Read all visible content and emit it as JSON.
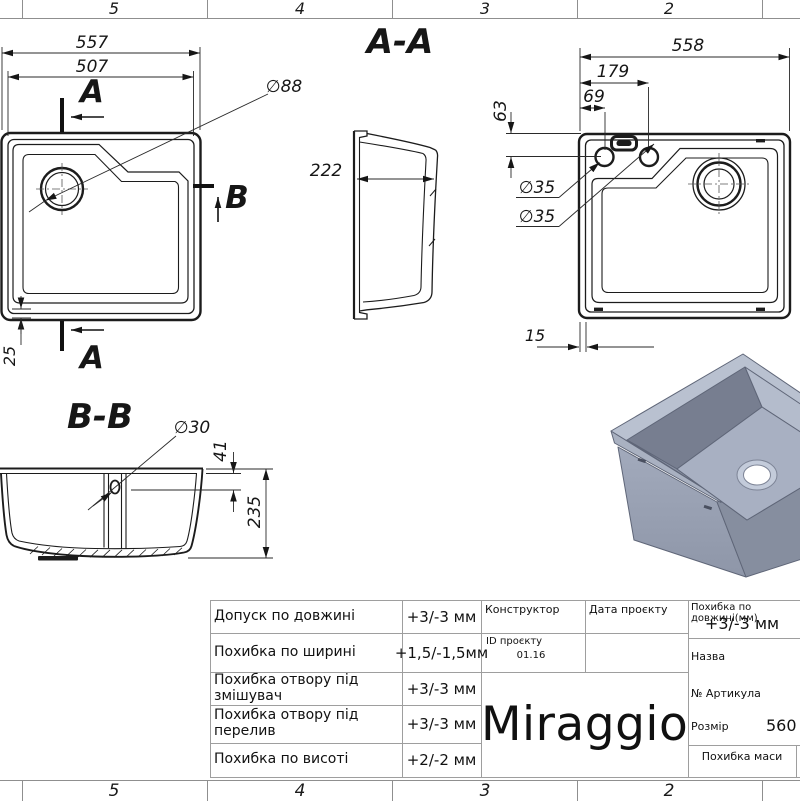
{
  "page": {
    "background": "#ffffff",
    "line_color": "#1c1c1c",
    "grid_color": "#9e9e9e"
  },
  "rulers": {
    "top": [
      "5",
      "4",
      "3",
      "2"
    ],
    "bottom": [
      "5",
      "4",
      "3",
      "2"
    ]
  },
  "labels": {
    "section_aa": "A-A",
    "section_bb": "B-B",
    "cut_a_top": "A",
    "cut_a_bottom": "A",
    "cut_b": "B"
  },
  "dimensions": {
    "top_view": {
      "outer_width": "557",
      "inner_width": "507",
      "drain_diameter": "∅88",
      "corner_offset": "25"
    },
    "section_aa": {
      "depth": "222"
    },
    "plan_view": {
      "outer_width": "558",
      "holes_span": "179",
      "hole_offset": "69",
      "holes_top_offset": "63",
      "faucet_hole_1": "∅35",
      "faucet_hole_2": "∅35",
      "flange_width": "15"
    },
    "section_bb": {
      "overflow_diameter": "∅30",
      "overflow_offset": "41",
      "height": "235"
    }
  },
  "title_block": {
    "tolerance_rows": [
      {
        "label": "Допуск по довжині",
        "value": "+3/-3 мм"
      },
      {
        "label": "Похибка по ширині",
        "value": "+1,5/-1,5мм"
      },
      {
        "label": "Похибка отвору під змішувач",
        "value": "+3/-3 мм"
      },
      {
        "label": "Похибка отвору під перелив",
        "value": "+3/-3 мм"
      },
      {
        "label": "Похибка по висоті",
        "value": "+2/-2 мм"
      }
    ],
    "constructor_label": "Конструктор",
    "project_date_label": "Дата проєкту",
    "length_tolerance_label": "Похибка по довжині(мм)",
    "length_tolerance_value": "+3/-3 мм",
    "project_id_label": "ID проєкту",
    "project_id_value": "01.16",
    "name_label": "Назва",
    "article_label": "№ Артикула",
    "brand": "Miraggio",
    "size_label": "Розмір",
    "size_value": "560",
    "mass_label": "Похибка маси"
  },
  "render_preview": {
    "rim_color": "#b9c1d0",
    "body_color": "#99a1b3",
    "shadow_color": "#777e90",
    "floor_color": "#a8b0c2"
  }
}
